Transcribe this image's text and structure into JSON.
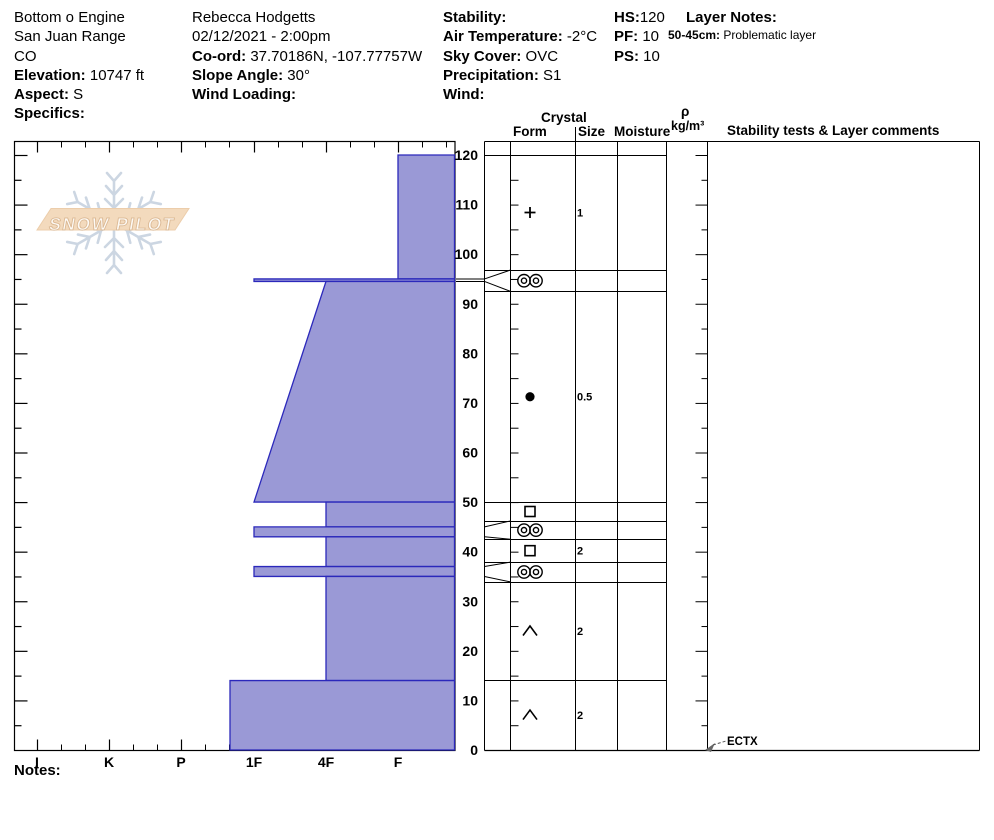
{
  "header": {
    "location": {
      "lines": [
        {
          "b": "",
          "t": "Bottom o Engine"
        },
        {
          "b": "",
          "t": "San Juan Range"
        },
        {
          "b": "",
          "t": "CO"
        },
        {
          "b": "Elevation:",
          "t": " 10747 ft"
        },
        {
          "b": "Aspect:",
          "t": " S"
        },
        {
          "b": "Specifics:",
          "t": ""
        }
      ]
    },
    "observer": {
      "lines": [
        {
          "b": "",
          "t": "Rebecca Hodgetts"
        },
        {
          "b": "",
          "t": "02/12/2021 - 2:00pm"
        },
        {
          "b": "Co-ord:",
          "t": " 37.70186N, -107.77757W"
        },
        {
          "b": "Slope Angle:",
          "t": " 30°"
        },
        {
          "b": "Wind Loading:",
          "t": ""
        }
      ]
    },
    "conditions": {
      "lines": [
        {
          "b": "Stability:",
          "t": ""
        },
        {
          "b": "Air Temperature:",
          "t": " -2°C"
        },
        {
          "b": "Sky Cover:",
          "t": " OVC"
        },
        {
          "b": "Precipitation:",
          "t": " S1"
        },
        {
          "b": "Wind:",
          "t": ""
        }
      ]
    },
    "pit": {
      "lines": [
        {
          "b": "HS:",
          "t": "120"
        },
        {
          "b": "PF:",
          "t": " 10"
        },
        {
          "b": "PS:",
          "t": " 10"
        }
      ]
    },
    "layer_notes": {
      "title": "Layer Notes:",
      "note_label": "50-45cm:",
      "note": " Problematic layer"
    }
  },
  "watermark": {
    "text": "SNOW PILOT"
  },
  "columns": {
    "crystal": "Crystal",
    "form": "Form",
    "size": "Size",
    "moisture": "Moisture",
    "rho": "ρ",
    "rho_units": "kg/m³",
    "stability": "Stability tests & Layer comments"
  },
  "notes_label": "Notes:",
  "annotations": {
    "ect": "ECTX"
  },
  "colors": {
    "bar_fill": "#9a99d6",
    "bar_stroke": "#2b28bb",
    "line": "#000000",
    "logo_band": "#f2d6b6",
    "logo_band_stroke": "#eac8a2",
    "logo_flake": "#c7d2df",
    "logo_text_fill": "#fdfaf5",
    "logo_text_stroke": "#d8b28a"
  },
  "chart_data": {
    "type": "snow-profile",
    "title": "",
    "depth_axis": {
      "unit": "cm",
      "max": 120,
      "labels": [
        0,
        10,
        20,
        30,
        40,
        50,
        60,
        70,
        80,
        90,
        100,
        110,
        120
      ],
      "minor_step": 5
    },
    "hardness_axis": {
      "categories": [
        "I",
        "K",
        "P",
        "1F",
        "4F",
        "F"
      ]
    },
    "total_depth": 120,
    "layers": [
      {
        "top": 120,
        "bottom": 95,
        "hardness": "F",
        "grain_symbol": "plus",
        "size": "1",
        "row_top": 120,
        "row_bottom": 96.8
      },
      {
        "top": 95,
        "bottom": 94.5,
        "hardness": "1F",
        "grain_symbol": "double-circle",
        "size": "",
        "row_top": 96.8,
        "row_bottom": 92.5
      },
      {
        "top": 94.5,
        "bottom": 50,
        "hardness_top": "4F",
        "hardness_bottom": "1F",
        "grain_symbol": "dot",
        "size": "0.5",
        "row_top": 92.5,
        "row_bottom": 50
      },
      {
        "top": 50,
        "bottom": 45,
        "hardness": "4F",
        "grain_symbol": "square",
        "size": "",
        "row_top": 50,
        "row_bottom": 46.2
      },
      {
        "top": 45,
        "bottom": 43,
        "hardness": "1F",
        "grain_symbol": "double-circle",
        "size": "",
        "row_top": 46.2,
        "row_bottom": 42.5
      },
      {
        "top": 43,
        "bottom": 37,
        "hardness": "4F",
        "grain_symbol": "square",
        "size": "2",
        "row_top": 42.5,
        "row_bottom": 37.9
      },
      {
        "top": 37,
        "bottom": 35,
        "hardness": "1F",
        "grain_symbol": "double-circle",
        "size": "",
        "row_top": 37.9,
        "row_bottom": 33.9
      },
      {
        "top": 35,
        "bottom": 14,
        "hardness": "4F",
        "grain_symbol": "caret",
        "size": "2",
        "row_top": 33.9,
        "row_bottom": 14.1
      },
      {
        "top": 14,
        "bottom": 0,
        "hardness": "1F+",
        "grain_symbol": "caret",
        "size": "2",
        "row_top": 14.1,
        "row_bottom": 0
      }
    ],
    "stability_tests": [
      "ECTX"
    ]
  }
}
